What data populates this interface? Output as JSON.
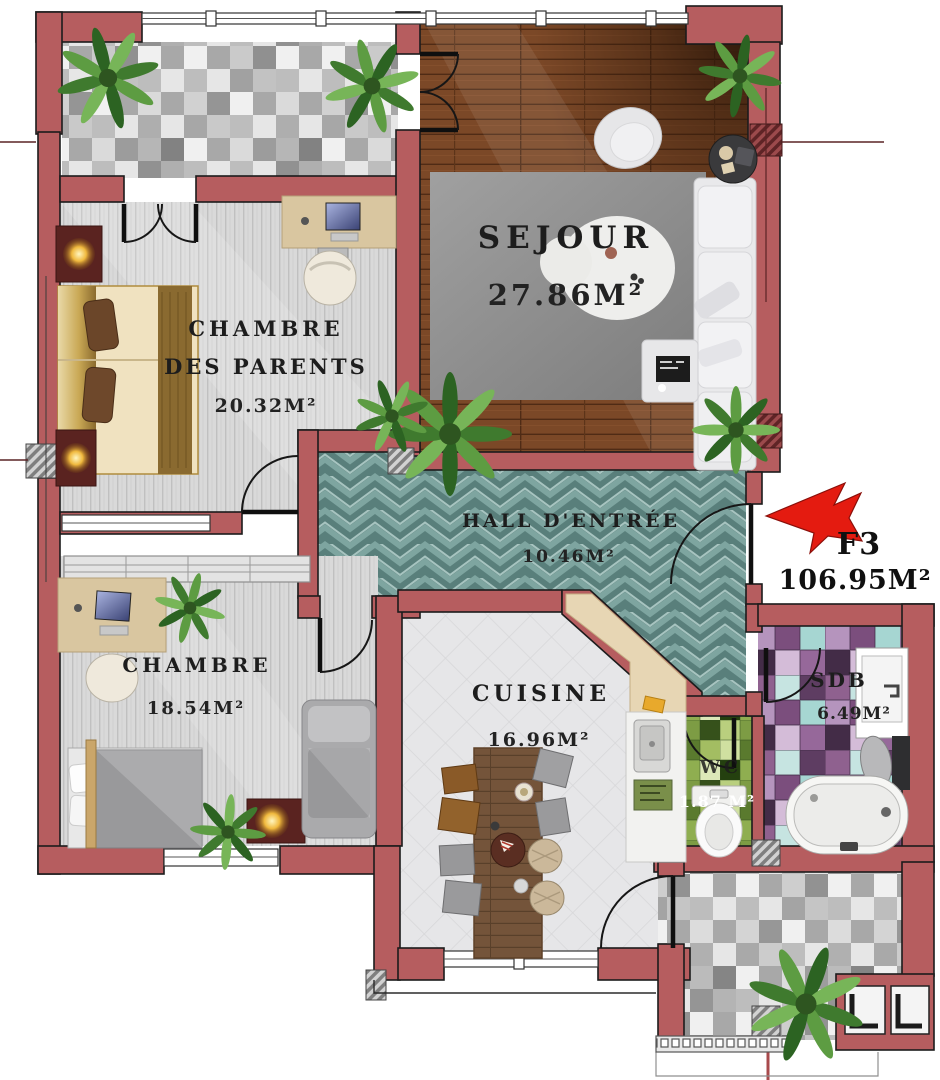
{
  "plan": {
    "unit": {
      "label": "F3",
      "area": "106.95M²"
    },
    "rooms": [
      {
        "id": "sejour",
        "label": "SEJOUR",
        "area": "27.86M²"
      },
      {
        "id": "chambre-parents",
        "label": "CHAMBRE",
        "label2": "DES PARENTS",
        "area": "20.32M²"
      },
      {
        "id": "hall-entree",
        "label": "HALL D'ENTRÉE",
        "area": "10.46M²"
      },
      {
        "id": "chambre",
        "label": "CHAMBRE",
        "area": "18.54M²"
      },
      {
        "id": "cuisine",
        "label": "CUISINE",
        "area": "16.96M²"
      },
      {
        "id": "sdb",
        "label": "SDB",
        "area": "6.49M²"
      },
      {
        "id": "wc",
        "label": "WC",
        "area": "1.87 M²"
      }
    ],
    "colors": {
      "wall": "#b65d5f",
      "hall_tile": "#7ea5a0",
      "wood_floor": "#7b4827",
      "wc_tile": "#95b25a",
      "sdb_tile": "#8f6490",
      "arrow": "#e41b10",
      "text": "#1d1d1d"
    }
  }
}
